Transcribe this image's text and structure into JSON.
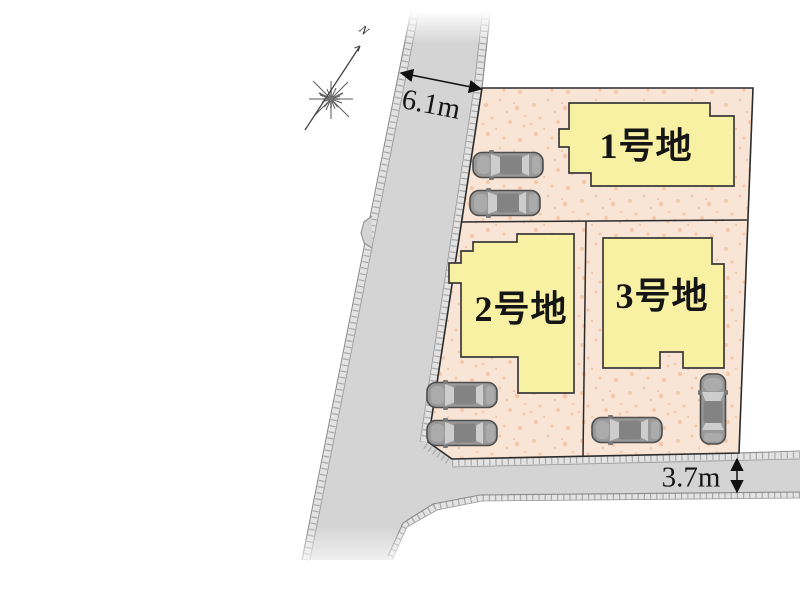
{
  "compass": {
    "north_label": "N"
  },
  "dimensions": {
    "west_road_width": "6.1m",
    "south_road_width": "3.7m"
  },
  "lots": [
    {
      "label": "1号地"
    },
    {
      "label": "2号地"
    },
    {
      "label": "3号地"
    }
  ],
  "cars": {
    "count": 6
  },
  "colors": {
    "road": "#d4d4d4",
    "road_edge": "#8a8a8a",
    "parcel": "#f9e5d6",
    "parcel_speckle": "#f2c4a4",
    "house_fill": "#f8f1a4",
    "boundary": "#2b2b2b",
    "car_body": "#999999",
    "dimension_text": "#151515"
  }
}
